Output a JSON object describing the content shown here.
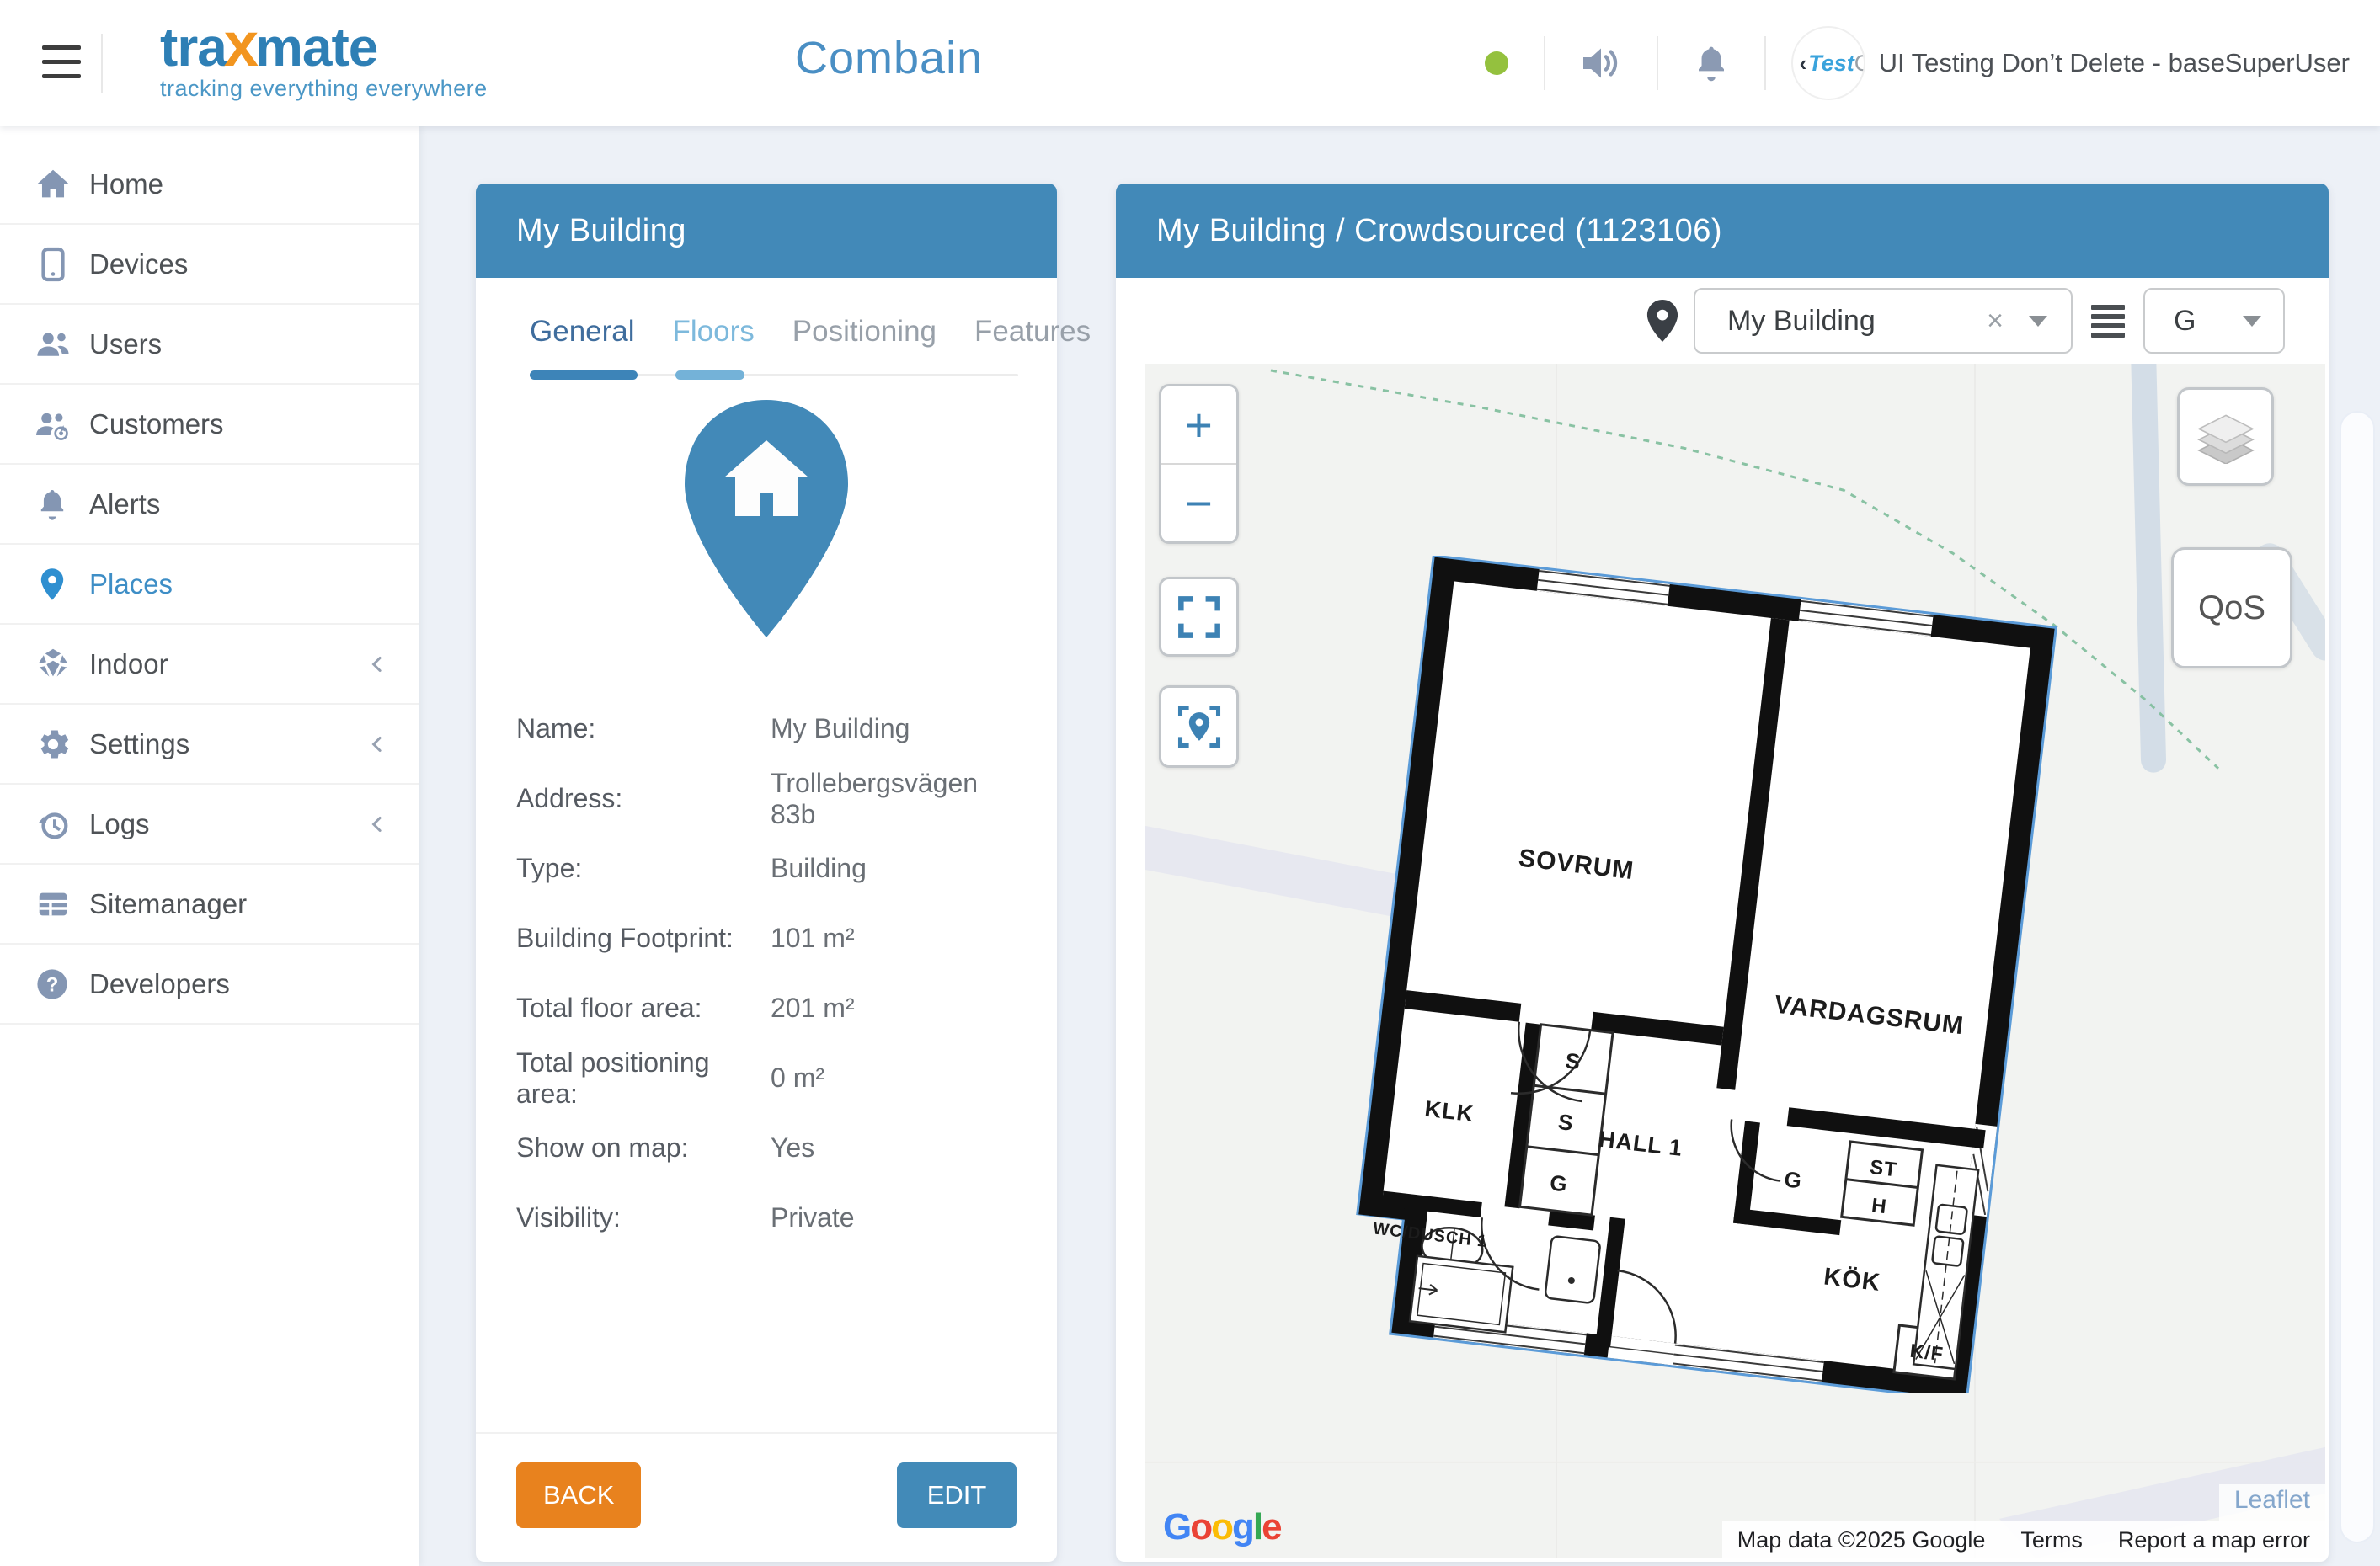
{
  "header": {
    "brand": "traxmate",
    "tagline": "tracking everything everywhere",
    "app_title": "Combain",
    "status_color": "#94c13e",
    "avatar_text_mark": "‹",
    "avatar_text_primary": "Test",
    "avatar_text_secondary": "Ca",
    "user_label": "UI Testing Don’t Delete - baseSuperUser"
  },
  "sidebar": {
    "items": [
      {
        "label": "Home"
      },
      {
        "label": "Devices"
      },
      {
        "label": "Users"
      },
      {
        "label": "Customers"
      },
      {
        "label": "Alerts"
      },
      {
        "label": "Places"
      },
      {
        "label": "Indoor"
      },
      {
        "label": "Settings"
      },
      {
        "label": "Logs"
      },
      {
        "label": "Sitemanager"
      },
      {
        "label": "Developers"
      }
    ]
  },
  "building_panel": {
    "title": "My Building",
    "tabs": [
      {
        "label": "General"
      },
      {
        "label": "Floors"
      },
      {
        "label": "Positioning"
      },
      {
        "label": "Features"
      }
    ],
    "details": [
      {
        "label": "Name:",
        "value": "My Building"
      },
      {
        "label": "Address:",
        "value": "Trollebergsvägen 83b"
      },
      {
        "label": "Type:",
        "value": "Building"
      },
      {
        "label": "Building Footprint:",
        "value": "101 m²"
      },
      {
        "label": "Total floor area:",
        "value": "201 m²"
      },
      {
        "label": "Total positioning area:",
        "value": "0 m²"
      },
      {
        "label": "Show on map:",
        "value": "Yes"
      },
      {
        "label": "Visibility:",
        "value": "Private"
      }
    ],
    "back_label": "BACK",
    "edit_label": "EDIT"
  },
  "map_panel": {
    "title": "My Building / Crowdsourced (1123106)",
    "place_select_value": "My Building",
    "clear_glyph": "×",
    "floor_select_value": "G",
    "zoom_in": "+",
    "zoom_out": "−",
    "qos_label": "QoS",
    "floorplan": {
      "rooms": {
        "bedroom": "SOVRUM",
        "living": "VARDAGSRUM",
        "closet": "KLK",
        "hall": "HALL 1",
        "kitchen": "KÖK",
        "bath": "WC/DUSCH 1"
      },
      "cells": {
        "s1": "S",
        "s2": "S",
        "g1": "G",
        "g2": "G",
        "st": "ST",
        "h": "H",
        "kf": "K/F"
      }
    },
    "attribution": {
      "leaflet": "Leaflet",
      "map_data": "Map data ©2025 Google",
      "terms": "Terms",
      "report": "Report a map error",
      "google_letters": [
        "G",
        "o",
        "o",
        "g",
        "l",
        "e"
      ]
    }
  }
}
